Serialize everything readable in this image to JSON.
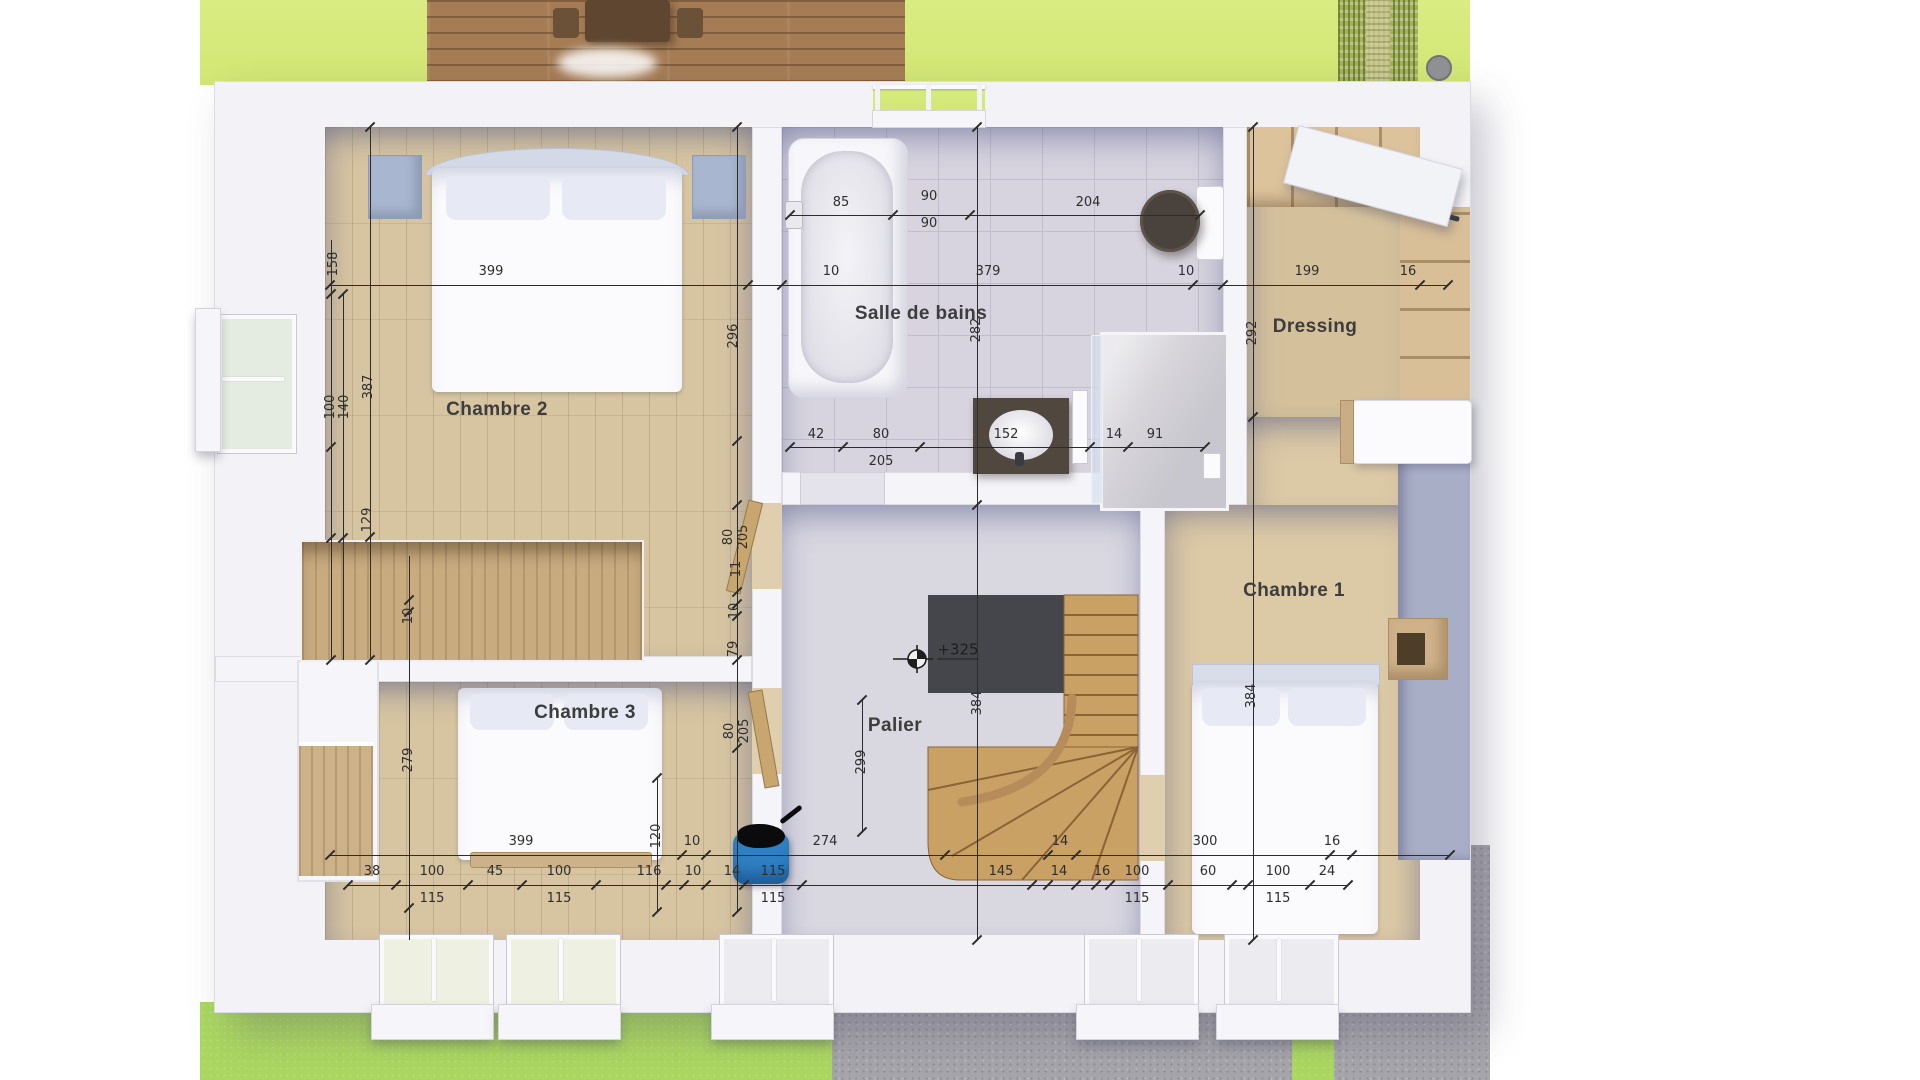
{
  "rooms": {
    "chambre2": "Chambre 2",
    "salle_de_bains": "Salle de bains",
    "dressing": "Dressing",
    "chambre1": "Chambre 1",
    "chambre3": "Chambre 3",
    "palier": "Palier"
  },
  "level_marker": "+325",
  "colors": {
    "grass_top": "#d5e87c",
    "grass_bottom": "#abd761",
    "gravel": "#a6a5ab",
    "deck_wood": "#a57c54",
    "wall": "#f3f2f6",
    "parquet": "#d7c5a2",
    "tile": "#d7d4df",
    "dim_text": "#2e2e2e",
    "pet_bed_blue": "#2f7fc2"
  },
  "dimension_labels": [
    {
      "t": "399",
      "x": 491,
      "y": 272
    },
    {
      "t": "10",
      "x": 831,
      "y": 272
    },
    {
      "t": "379",
      "x": 988,
      "y": 272
    },
    {
      "t": "10",
      "x": 1186,
      "y": 272
    },
    {
      "t": "199",
      "x": 1307,
      "y": 272
    },
    {
      "t": "16",
      "x": 1408,
      "y": 272
    },
    {
      "t": "85",
      "x": 841,
      "y": 203
    },
    {
      "t": "90",
      "x": 929,
      "y": 197
    },
    {
      "t": "90",
      "x": 929,
      "y": 224
    },
    {
      "t": "204",
      "x": 1088,
      "y": 203
    },
    {
      "t": "42",
      "x": 816,
      "y": 435
    },
    {
      "t": "80",
      "x": 881,
      "y": 435
    },
    {
      "t": "205",
      "x": 881,
      "y": 462
    },
    {
      "t": "152",
      "x": 1006,
      "y": 435
    },
    {
      "t": "14",
      "x": 1114,
      "y": 435
    },
    {
      "t": "91",
      "x": 1155,
      "y": 435
    },
    {
      "t": "399",
      "x": 521,
      "y": 842
    },
    {
      "t": "10",
      "x": 692,
      "y": 842
    },
    {
      "t": "274",
      "x": 825,
      "y": 842
    },
    {
      "t": "14",
      "x": 1060,
      "y": 842
    },
    {
      "t": "300",
      "x": 1205,
      "y": 842
    },
    {
      "t": "16",
      "x": 1332,
      "y": 842
    },
    {
      "t": "38",
      "x": 372,
      "y": 872
    },
    {
      "t": "100",
      "x": 432,
      "y": 872
    },
    {
      "t": "115",
      "x": 432,
      "y": 899
    },
    {
      "t": "45",
      "x": 495,
      "y": 872
    },
    {
      "t": "100",
      "x": 559,
      "y": 872
    },
    {
      "t": "115",
      "x": 559,
      "y": 899
    },
    {
      "t": "116",
      "x": 649,
      "y": 872
    },
    {
      "t": "10",
      "x": 693,
      "y": 872
    },
    {
      "t": "14",
      "x": 732,
      "y": 872
    },
    {
      "t": "115",
      "x": 773,
      "y": 872
    },
    {
      "t": "115",
      "x": 773,
      "y": 899
    },
    {
      "t": "145",
      "x": 1001,
      "y": 872
    },
    {
      "t": "14",
      "x": 1059,
      "y": 872
    },
    {
      "t": "16",
      "x": 1102,
      "y": 872
    },
    {
      "t": "100",
      "x": 1137,
      "y": 872
    },
    {
      "t": "115",
      "x": 1137,
      "y": 899
    },
    {
      "t": "60",
      "x": 1208,
      "y": 872
    },
    {
      "t": "100",
      "x": 1278,
      "y": 872
    },
    {
      "t": "115",
      "x": 1278,
      "y": 899
    },
    {
      "t": "24",
      "x": 1327,
      "y": 872
    },
    {
      "t": "158",
      "x": 334,
      "y": 264,
      "r": 1
    },
    {
      "t": "100",
      "x": 331,
      "y": 407,
      "r": 1
    },
    {
      "t": "140",
      "x": 345,
      "y": 407,
      "r": 1
    },
    {
      "t": "387",
      "x": 369,
      "y": 387,
      "r": 1
    },
    {
      "t": "129",
      "x": 368,
      "y": 520,
      "r": 1
    },
    {
      "t": "10",
      "x": 409,
      "y": 616,
      "r": 1
    },
    {
      "t": "279",
      "x": 409,
      "y": 760,
      "r": 1
    },
    {
      "t": "120",
      "x": 657,
      "y": 836,
      "r": 1
    },
    {
      "t": "296",
      "x": 734,
      "y": 336,
      "r": 1
    },
    {
      "t": "80",
      "x": 729,
      "y": 537,
      "r": 1
    },
    {
      "t": "205",
      "x": 744,
      "y": 537,
      "r": 1
    },
    {
      "t": "11",
      "x": 737,
      "y": 569,
      "r": 1
    },
    {
      "t": "10",
      "x": 735,
      "y": 611,
      "r": 1
    },
    {
      "t": "79",
      "x": 734,
      "y": 649,
      "r": 1
    },
    {
      "t": "80",
      "x": 730,
      "y": 731,
      "r": 1
    },
    {
      "t": "205",
      "x": 745,
      "y": 731,
      "r": 1
    },
    {
      "t": "282",
      "x": 977,
      "y": 330,
      "r": 1
    },
    {
      "t": "384",
      "x": 978,
      "y": 703,
      "r": 1
    },
    {
      "t": "299",
      "x": 862,
      "y": 762,
      "r": 1
    },
    {
      "t": "292",
      "x": 1253,
      "y": 333,
      "r": 1
    },
    {
      "t": "384",
      "x": 1252,
      "y": 696,
      "r": 1
    }
  ]
}
